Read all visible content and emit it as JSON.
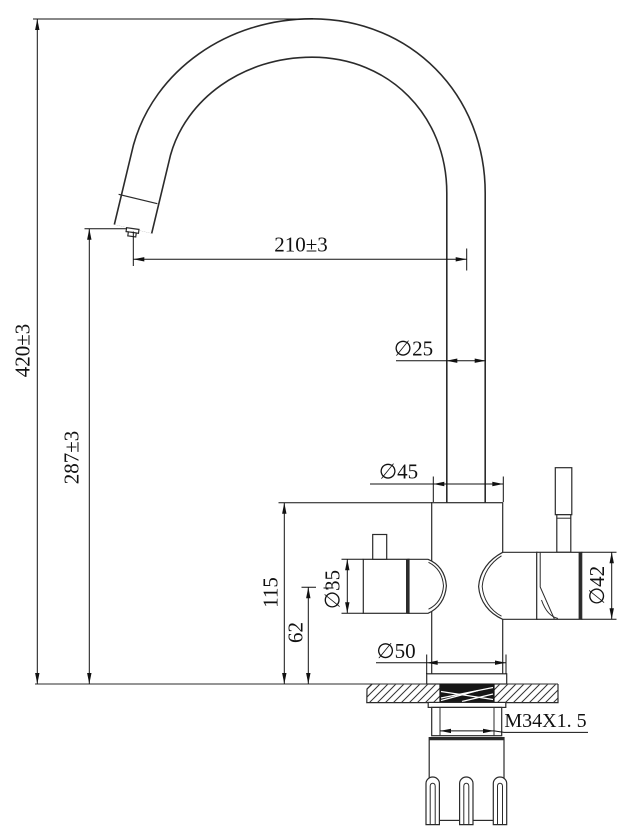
{
  "drawing": {
    "background": "#ffffff",
    "line_color": "#2b2b2b",
    "dimension_color": "#111111",
    "dimensions": {
      "total_height": "420±3",
      "outlet_height": "287±3",
      "spout_reach": "210±3",
      "spout_tube_diameter": "∅25",
      "body_diameter": "∅45",
      "left_handle_diameter": "∅35",
      "right_handle_diameter": "∅42",
      "base_diameter": "∅50",
      "body_shoulder_height": "115",
      "side_valve_axis_height": "62",
      "mounting_thread": "M34X1. 5"
    }
  }
}
